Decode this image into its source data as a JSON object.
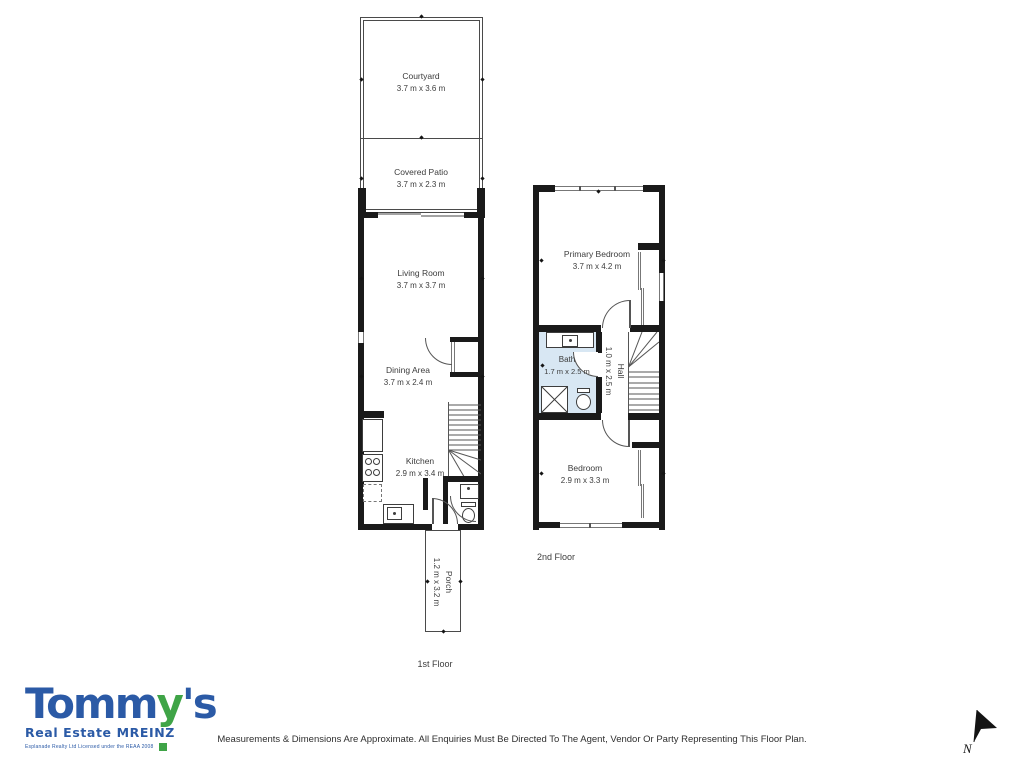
{
  "first_floor": {
    "label": "1st Floor",
    "rooms": {
      "courtyard": {
        "name": "Courtyard",
        "dims": "3.7 m x 3.6 m"
      },
      "covered_patio": {
        "name": "Covered Patio",
        "dims": "3.7 m x 2.3 m"
      },
      "living_room": {
        "name": "Living Room",
        "dims": "3.7 m x 3.7 m"
      },
      "dining_area": {
        "name": "Dining Area",
        "dims": "3.7 m x 2.4 m"
      },
      "kitchen": {
        "name": "Kitchen",
        "dims": "2.9 m x 3.4 m"
      },
      "porch": {
        "name": "Porch",
        "dims": "1.2 m x 3.2 m"
      }
    }
  },
  "second_floor": {
    "label": "2nd Floor",
    "rooms": {
      "primary_bedroom": {
        "name": "Primary Bedroom",
        "dims": "3.7 m x 4.2 m"
      },
      "bath": {
        "name": "Bath",
        "dims": "1.7 m x 2.5 m"
      },
      "hall": {
        "name": "Hall",
        "dims": "1.0 m x 2.5 m"
      },
      "bedroom": {
        "name": "Bedroom",
        "dims": "2.9 m x 3.3 m"
      }
    }
  },
  "branding": {
    "logo_part1": "Tomm",
    "logo_part2": "y",
    "logo_part3": "'s",
    "tagline": "Real Estate MREINZ",
    "license": "Esplanade Realty Ltd Licensed under the REAA 2008",
    "brand_blue": "#2b5aa6",
    "brand_green": "#3fa447"
  },
  "footer": {
    "disclaimer": "Measurements & Dimensions Are Approximate. All Enquiries Must Be Directed To The Agent, Vendor Or Party Representing This Floor Plan."
  },
  "compass": {
    "label": "N"
  },
  "colors": {
    "wall": "#1a1a1a",
    "bath_fill": "#d8e7f3",
    "label_text": "#3c3c3c"
  }
}
